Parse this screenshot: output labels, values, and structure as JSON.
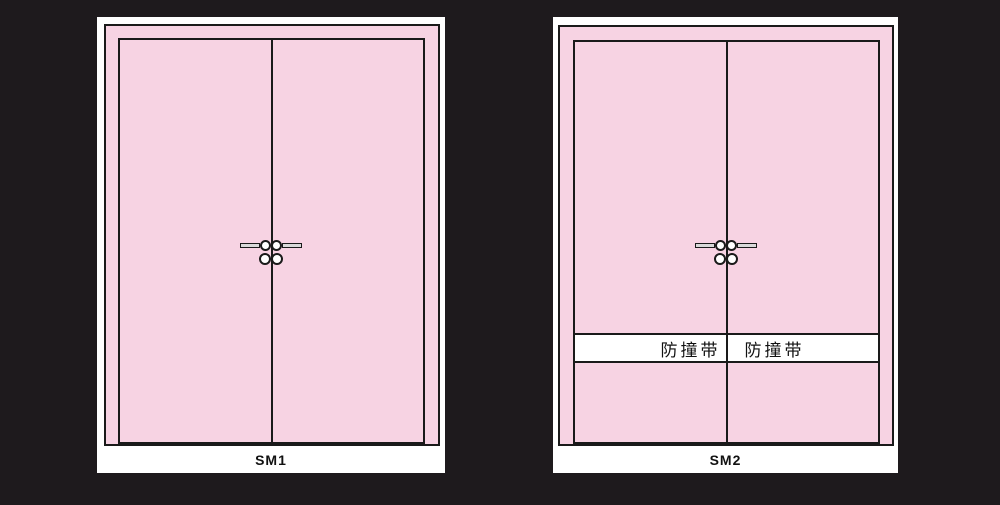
{
  "colors": {
    "background": "#1e1a1d",
    "door_pink": "#f7d3e3",
    "outline": "#1a1a1a",
    "panel_white": "#ffffff",
    "hardware_gray": "#d9d9d9"
  },
  "icons": [
    "door-handle-icon",
    "handle-lever-icon",
    "door-knob-icon",
    "lock-cylinder-icon"
  ],
  "panels": [
    {
      "label": "SM1",
      "type": "double-door-elevation"
    },
    {
      "label": "SM2",
      "type": "double-door-elevation-with-bump-strip",
      "strip_left": "防撞带",
      "strip_right": "防撞带"
    }
  ]
}
